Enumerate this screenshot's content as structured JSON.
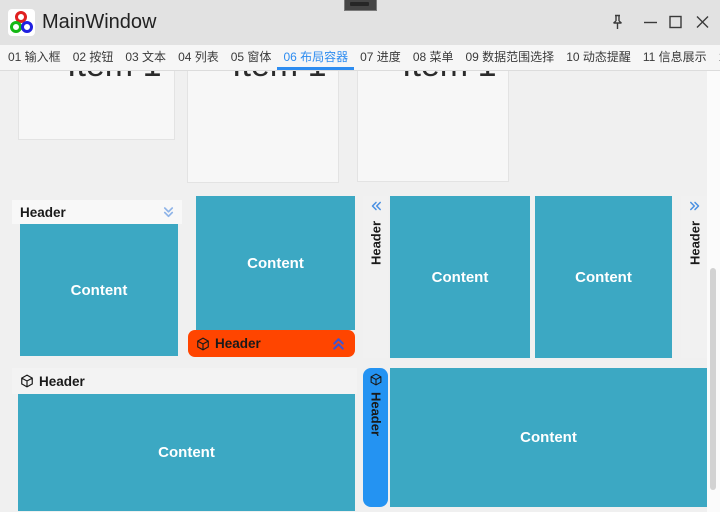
{
  "titlebar": {
    "title": "MainWindow",
    "app_icon": "rgb-rings-logo",
    "controls": [
      {
        "name": "pin-icon"
      },
      {
        "name": "minimize-icon"
      },
      {
        "name": "maximize-icon"
      },
      {
        "name": "close-icon"
      }
    ]
  },
  "tabbar": {
    "active_index": 5,
    "tabs": [
      {
        "label": "01 输入框"
      },
      {
        "label": "02 按钮"
      },
      {
        "label": "03 文本"
      },
      {
        "label": "04 列表"
      },
      {
        "label": "05 窗体"
      },
      {
        "label": "06 布局容器"
      },
      {
        "label": "07 进度"
      },
      {
        "label": "08 菜单"
      },
      {
        "label": "09 数据范围选择"
      },
      {
        "label": "10 动态提醒"
      },
      {
        "label": "11 信息展示"
      },
      {
        "label": "12 未分类"
      }
    ]
  },
  "items_row": {
    "items": [
      {
        "label": "Item 1"
      },
      {
        "label": "Item 1"
      },
      {
        "label": "Item 1"
      }
    ]
  },
  "panels": {
    "top_header": {
      "header": "Header",
      "content": "Content",
      "chevron_icon": "double-chevron-down-icon"
    },
    "bottom_header": {
      "header": "Header",
      "content": "Content",
      "chevron_icon": "double-chevron-up-icon",
      "header_icon": "cube-icon"
    },
    "left_header": {
      "header": "Header",
      "content": "Content",
      "chevron_icon": "double-chevron-left-icon"
    },
    "right_header": {
      "header": "Header",
      "content": "Content",
      "chevron_icon": "double-chevron-right-icon"
    },
    "bottom_left": {
      "header": "Header",
      "content": "Content",
      "header_icon": "cube-icon"
    },
    "bottom_right": {
      "header": "Header",
      "content": "Content",
      "header_icon": "cube-icon"
    }
  },
  "colors": {
    "content_teal": "#3CA8C3",
    "header_orange": "#FF4500",
    "header_blue": "#2493F2",
    "active_tab_blue": "#2D8CF0",
    "chevron_blue": "#4A7BD8",
    "titlebar_bg": "#E2E2E2",
    "page_bg": "#F0F0F0"
  }
}
